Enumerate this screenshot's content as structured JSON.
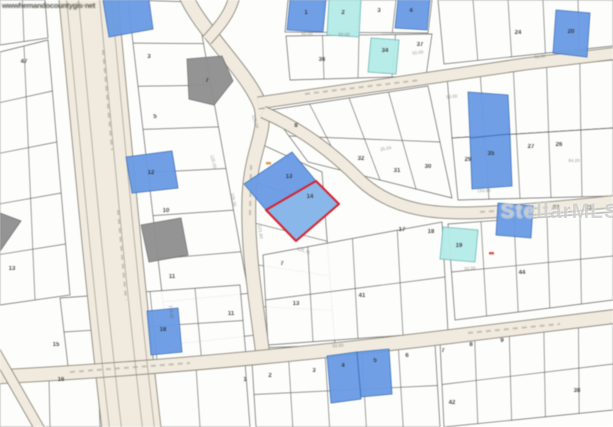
{
  "watermarks": {
    "mls": "StellarMLS",
    "corner_url": "wwwhemandocountygis·net"
  },
  "palette": {
    "map_bg": "#fdfdfb",
    "parcel_fill": "#fefdfb",
    "parcel_line": "#555555",
    "road_fill": "#f0ebdf",
    "road_edge": "#8d887c",
    "lot_blue": "#6b9be0",
    "lot_blue_edge": "#3a6cb4",
    "lot_cyan": "#b7ebe9",
    "lot_cyan_edge": "#66b4b2",
    "lot_gray": "#8f8f8f",
    "lot_gray_edge": "#6e6e6e",
    "subject_fill": "#8cb7e6",
    "subject_outline": "#d0222e",
    "label_color": "#2a2a2a",
    "dim_color": "#5a5a5a"
  },
  "map": {
    "subject_parcel": {
      "lot_number": "14",
      "points": [
        [
          266,
          210
        ],
        [
          316,
          181
        ],
        [
          339,
          204
        ],
        [
          296,
          241
        ]
      ]
    },
    "highlighted_parcels": [
      {
        "lot_number": "13",
        "color": "blue",
        "points": [
          [
            244,
            184
          ],
          [
            292,
            152
          ],
          [
            316,
            181
          ],
          [
            266,
            210
          ]
        ]
      },
      {
        "lot_number": "",
        "color": "blue",
        "points": [
          [
            103,
            0
          ],
          [
            149,
            0
          ],
          [
            153,
            29
          ],
          [
            109,
            37
          ]
        ]
      },
      {
        "lot_number": "1",
        "color": "blue",
        "points": [
          [
            290,
            0
          ],
          [
            326,
            0
          ],
          [
            323,
            32
          ],
          [
            287,
            30
          ]
        ]
      },
      {
        "lot_number": "4",
        "color": "blue",
        "points": [
          [
            398,
            0
          ],
          [
            430,
            0
          ],
          [
            427,
            30
          ],
          [
            395,
            28
          ]
        ]
      },
      {
        "lot_number": "20",
        "color": "blue",
        "points": [
          [
            556,
            10
          ],
          [
            590,
            13
          ],
          [
            587,
            57
          ],
          [
            553,
            53
          ]
        ]
      },
      {
        "lot_number": "",
        "color": "blue",
        "points": [
          [
            468,
            92
          ],
          [
            508,
            95
          ],
          [
            510,
            134
          ],
          [
            470,
            138
          ]
        ]
      },
      {
        "lot_number": "35",
        "color": "blue",
        "points": [
          [
            470,
            138
          ],
          [
            510,
            134
          ],
          [
            512,
            186
          ],
          [
            472,
            189
          ]
        ]
      },
      {
        "lot_number": "",
        "color": "blue",
        "points": [
          [
            498,
            203
          ],
          [
            533,
            206
          ],
          [
            531,
            238
          ],
          [
            496,
            235
          ]
        ]
      },
      {
        "lot_number": "12",
        "color": "blue",
        "points": [
          [
            126,
            157
          ],
          [
            172,
            151
          ],
          [
            178,
            188
          ],
          [
            132,
            193
          ]
        ]
      },
      {
        "lot_number": "18",
        "color": "blue",
        "points": [
          [
            147,
            311
          ],
          [
            178,
            308
          ],
          [
            182,
            352
          ],
          [
            151,
            355
          ]
        ]
      },
      {
        "lot_number": "4",
        "color": "blue",
        "points": [
          [
            327,
            356
          ],
          [
            357,
            352
          ],
          [
            361,
            399
          ],
          [
            331,
            403
          ]
        ]
      },
      {
        "lot_number": "5",
        "color": "blue",
        "points": [
          [
            357,
            352
          ],
          [
            389,
            349
          ],
          [
            392,
            394
          ],
          [
            361,
            397
          ]
        ]
      },
      {
        "lot_number": "2",
        "color": "cyan",
        "points": [
          [
            329,
            0
          ],
          [
            361,
            0
          ],
          [
            359,
            37
          ],
          [
            327,
            35
          ]
        ]
      },
      {
        "lot_number": "34",
        "color": "cyan",
        "points": [
          [
            371,
            38
          ],
          [
            399,
            40
          ],
          [
            396,
            74
          ],
          [
            368,
            72
          ]
        ]
      },
      {
        "lot_number": "19",
        "color": "cyan",
        "points": [
          [
            443,
            227
          ],
          [
            478,
            230
          ],
          [
            475,
            262
          ],
          [
            440,
            259
          ]
        ]
      },
      {
        "lot_number": "7",
        "color": "gray",
        "points": [
          [
            187,
            59
          ],
          [
            222,
            56
          ],
          [
            233,
            81
          ],
          [
            214,
            105
          ],
          [
            189,
            99
          ]
        ]
      },
      {
        "lot_number": "",
        "color": "gray",
        "points": [
          [
            0,
            213
          ],
          [
            21,
            221
          ],
          [
            0,
            251
          ]
        ]
      },
      {
        "lot_number": "",
        "color": "gray",
        "points": [
          [
            141,
            225
          ],
          [
            181,
            218
          ],
          [
            188,
            255
          ],
          [
            149,
            262
          ]
        ]
      }
    ],
    "lot_numbers": [
      [
        "1",
        306,
        14
      ],
      [
        "2",
        343,
        14
      ],
      [
        "3",
        379,
        12
      ],
      [
        "4",
        411,
        12
      ],
      [
        "24",
        518,
        34
      ],
      [
        "20",
        571,
        33
      ],
      [
        "36",
        322,
        61
      ],
      [
        "34",
        385,
        52
      ],
      [
        "37",
        420,
        46
      ],
      [
        "3",
        149,
        58
      ],
      [
        "5",
        155,
        118
      ],
      [
        "10",
        166,
        212
      ],
      [
        "11",
        172,
        278
      ],
      [
        "7",
        207,
        82
      ],
      [
        "8",
        296,
        127
      ],
      [
        "31",
        397,
        172
      ],
      [
        "30",
        428,
        168
      ],
      [
        "32",
        361,
        160
      ],
      [
        "27",
        531,
        148
      ],
      [
        "26",
        559,
        146
      ],
      [
        "35",
        491,
        155
      ],
      [
        "29",
        468,
        161
      ],
      [
        "23",
        556,
        209
      ],
      [
        "21",
        589,
        209
      ],
      [
        "17",
        402,
        231
      ],
      [
        "18",
        431,
        233
      ],
      [
        "19",
        459,
        247
      ],
      [
        "14",
        310,
        198
      ],
      [
        "13",
        289,
        178
      ],
      [
        "12",
        151,
        174
      ],
      [
        "7",
        282,
        265
      ],
      [
        "11",
        231,
        315
      ],
      [
        "13",
        296,
        305
      ],
      [
        "41",
        362,
        297
      ],
      [
        "44",
        522,
        274
      ],
      [
        "1",
        245,
        381
      ],
      [
        "2",
        270,
        377
      ],
      [
        "3",
        314,
        372
      ],
      [
        "4",
        343,
        367
      ],
      [
        "5",
        375,
        362
      ],
      [
        "6",
        407,
        357
      ],
      [
        "8",
        471,
        346
      ],
      [
        "9",
        502,
        342
      ],
      [
        "7",
        443,
        352
      ],
      [
        "38",
        577,
        392
      ],
      [
        "42",
        452,
        404
      ],
      [
        "15",
        56,
        346
      ],
      [
        "16",
        61,
        381
      ],
      [
        "13",
        12,
        270
      ],
      [
        "47",
        24,
        63
      ],
      [
        "18",
        163,
        331
      ]
    ],
    "dimension_texts": [
      [
        "50.00",
        307,
        35,
        0
      ],
      [
        "50.00",
        344,
        36,
        0
      ],
      [
        "125.04",
        254,
        122,
        72
      ],
      [
        "25.04",
        386,
        150,
        -10
      ],
      [
        "121.60",
        259,
        232,
        82
      ],
      [
        "50.00",
        452,
        98,
        -8
      ],
      [
        "110.00",
        484,
        192,
        -2
      ],
      [
        "125.00",
        212,
        162,
        75
      ],
      [
        "50.00",
        338,
        347,
        -5
      ],
      [
        "118.00",
        170,
        312,
        84
      ],
      [
        "50.00",
        540,
        58,
        -7
      ],
      [
        "125.75",
        303,
        252,
        22
      ],
      [
        "84.20",
        574,
        162,
        0
      ],
      [
        "50.00",
        418,
        54,
        -8
      ],
      [
        "50.00",
        470,
        270,
        -4
      ],
      [
        "105.00",
        232,
        200,
        78
      ]
    ],
    "roads": [
      {
        "d": "M88,-6 C100,120 112,260 132,433",
        "w": 58
      },
      {
        "d": "M185,-6 C200,30 248,72 261,107 C267,133 251,150 249,196 C247,250 256,300 263,356",
        "w": 13
      },
      {
        "d": "M235,-6 C231,14 218,28 207,40",
        "w": 10
      },
      {
        "d": "M258,103 C330,93 430,78 525,64 L618,53",
        "w": 11
      },
      {
        "d": "M263,112 C302,129 332,152 361,181 C396,213 441,215 491,212 C541,209 581,205 618,201",
        "w": 11
      },
      {
        "d": "M-6,377 C150,369 300,355 455,336 L618,316",
        "w": 13
      },
      {
        "d": "M-6,349 L42,433",
        "w": 9
      }
    ],
    "road_lines": [
      "M66,-6 C78,120 90,260 110,433",
      "M78,-6 C90,120 102,260 122,433",
      "M99,-6 C111,120 123,260 143,433",
      "M111,-6 C123,120 135,260 155,433"
    ],
    "text_smudges": [
      "M103,50 L112,150",
      "M118,210 L126,300",
      "M305,94 L420,80",
      "M480,212 L556,207",
      "M70,372 L190,363",
      "M468,333 L560,324",
      "M251,165 L250,215"
    ],
    "blocks": [
      {
        "corners": [
          [
            288,
            0
          ],
          [
            432,
            0
          ],
          [
            428,
            33
          ],
          [
            285,
            32
          ]
        ],
        "cols": 4,
        "rows": 1
      },
      {
        "corners": [
          [
            286,
            36
          ],
          [
            432,
            34
          ],
          [
            426,
            76
          ],
          [
            290,
            80
          ]
        ],
        "cols": 4,
        "rows": 1
      },
      {
        "corners": [
          [
            438,
            0
          ],
          [
            613,
            0
          ],
          [
            613,
            46
          ],
          [
            444,
            64
          ]
        ],
        "cols": 5,
        "rows": 1
      },
      {
        "corners": [
          [
            447,
            76
          ],
          [
            613,
            60
          ],
          [
            613,
            128
          ],
          [
            452,
            138
          ]
        ],
        "cols": 5,
        "rows": 1
      },
      {
        "corners": [
          [
            452,
            138
          ],
          [
            613,
            128
          ],
          [
            613,
            196
          ],
          [
            458,
            200
          ]
        ],
        "cols": 5,
        "rows": 1
      },
      {
        "corners": [
          [
            270,
            110
          ],
          [
            428,
            86
          ],
          [
            452,
            198
          ],
          [
            308,
            162
          ]
        ],
        "cols": 4,
        "rows": 2
      },
      {
        "corners": [
          [
            252,
            140
          ],
          [
            322,
            172
          ],
          [
            335,
            345
          ],
          [
            260,
            348
          ]
        ],
        "cols": 1,
        "rows": 5
      },
      {
        "corners": [
          [
            128,
            0
          ],
          [
            196,
            2
          ],
          [
            256,
            335
          ],
          [
            168,
            345
          ]
        ],
        "cols": 1,
        "rows": 8
      },
      {
        "corners": [
          [
            0,
            52
          ],
          [
            48,
            40
          ],
          [
            70,
            295
          ],
          [
            0,
            305
          ]
        ],
        "cols": 2,
        "rows": 5
      },
      {
        "corners": [
          [
            60,
            298
          ],
          [
            240,
            285
          ],
          [
            246,
            356
          ],
          [
            68,
            366
          ]
        ],
        "cols": 4,
        "rows": 2
      },
      {
        "corners": [
          [
            0,
            382
          ],
          [
            245,
            362
          ],
          [
            250,
            427
          ],
          [
            0,
            427
          ]
        ],
        "cols": 5,
        "rows": 1
      },
      {
        "corners": [
          [
            0,
            0
          ],
          [
            45,
            0
          ],
          [
            48,
            38
          ],
          [
            0,
            45
          ]
        ],
        "cols": 2,
        "rows": 1
      },
      {
        "corners": [
          [
            252,
            362
          ],
          [
            435,
            344
          ],
          [
            440,
            427
          ],
          [
            256,
            427
          ]
        ],
        "cols": 5,
        "rows": 2
      },
      {
        "corners": [
          [
            440,
            342
          ],
          [
            613,
            318
          ],
          [
            613,
            410
          ],
          [
            444,
            427
          ]
        ],
        "cols": 5,
        "rows": 2
      },
      {
        "corners": [
          [
            263,
            255
          ],
          [
            442,
            222
          ],
          [
            448,
            332
          ],
          [
            268,
            345
          ]
        ],
        "cols": 4,
        "rows": 2
      },
      {
        "corners": [
          [
            448,
            224
          ],
          [
            613,
            212
          ],
          [
            613,
            300
          ],
          [
            455,
            320
          ]
        ],
        "cols": 5,
        "rows": 2
      }
    ],
    "specks": [
      {
        "x": 266,
        "y": 162,
        "c": "#d98a3f"
      },
      {
        "x": 489,
        "y": 252,
        "c": "#cc4444"
      }
    ]
  }
}
